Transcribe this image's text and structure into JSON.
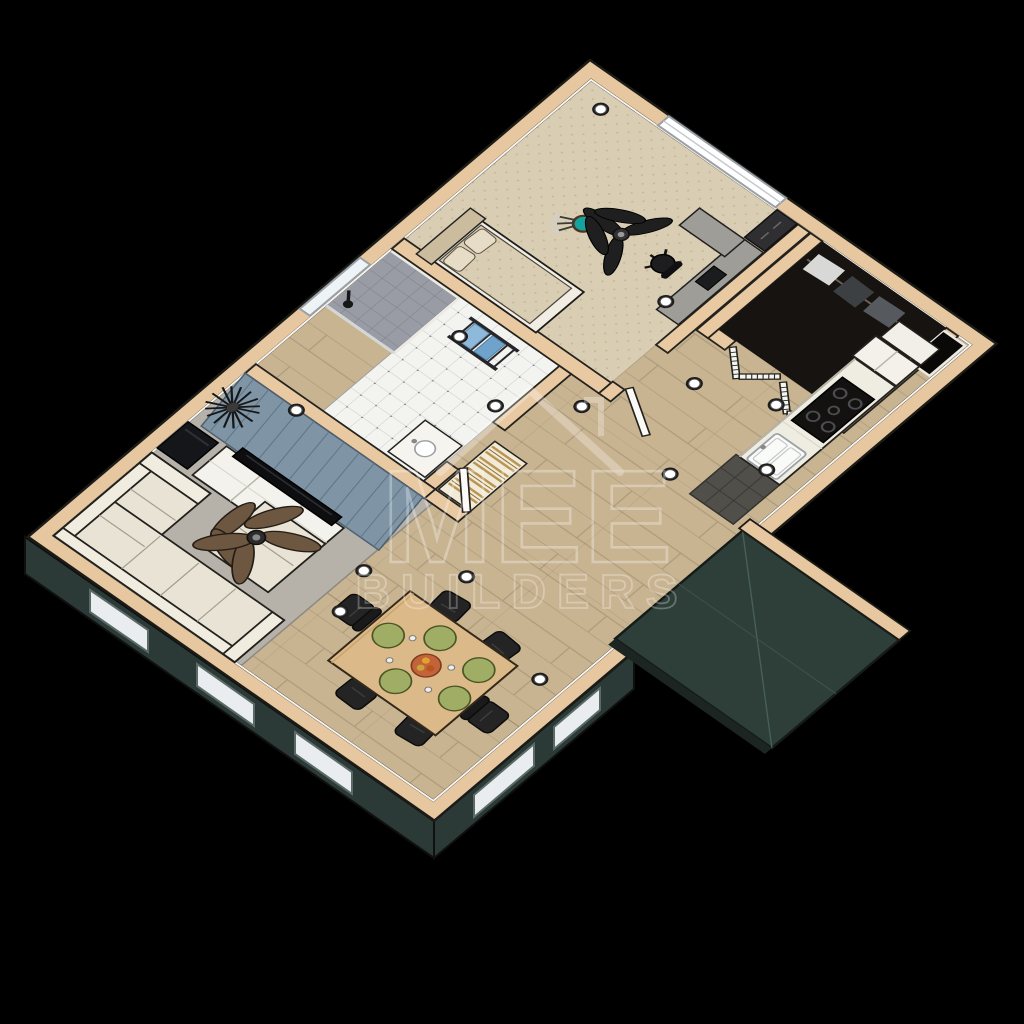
{
  "watermark": {
    "line1": "MEE",
    "line2": "BUILDERS",
    "icon": "house-roof-icon"
  },
  "scene": {
    "type": "3d-floor-plan-cutaway-render",
    "view": "aerial oblique, plan rotated diagonally on black background",
    "background_color": "#000000",
    "palette": {
      "floor_wood": "#c9b492",
      "bedroom_carpet": "#d9cdb3",
      "wall_cap_tan": "#e7c7a0",
      "wall_face_cream": "#efeade",
      "area_rug_gray": "#b7b2a9",
      "sofa_cream": "#e8e3d4",
      "accent_wall_blue": "#7f95a6",
      "exterior_teal": "#2c3b37",
      "golf_bag_teal": "#14a39e",
      "dining_table_wood": "#dcb988",
      "placemat_green": "#9fae64",
      "centerpiece_orange": "#c2633a",
      "fan_blade_brown": "#6d5741",
      "chair_black": "#242424",
      "bath_tile_white": "#f3f3ef",
      "shower_tile_gray": "#999ca4",
      "towel_blue": "#8fb9da"
    },
    "rooms": [
      {
        "name": "bedroom",
        "contents": [
          "bed-with-headboard-and-pillows",
          "golf-bag",
          "ceiling-fan",
          "desk",
          "office-chair",
          "dresser",
          "wide-window"
        ]
      },
      {
        "name": "bathroom",
        "contents": [
          "shower-stall",
          "checkered-tile-floor",
          "towel-ladder",
          "blue-towels",
          "vanity",
          "high-window",
          "shower-head"
        ]
      },
      {
        "name": "closet",
        "contents": [
          "bifold-louver-doors",
          "hanging-clothes",
          "corner-window-alcove"
        ]
      },
      {
        "name": "hallway",
        "contents": [
          "open-doors",
          "linen-louver-closet",
          "recessed-lights"
        ]
      },
      {
        "name": "kitchen",
        "contents": [
          "cooktop",
          "sink",
          "refrigerator",
          "pantry-cabinet",
          "counter",
          "dark-entry-mat"
        ]
      },
      {
        "name": "living-room",
        "contents": [
          "sectional-sofa",
          "ottoman",
          "area-rug",
          "tv-console",
          "flat-tv",
          "speaker-cabinet",
          "ceiling-fan",
          "starburst-wall-clock",
          "blue-accent-wall"
        ]
      },
      {
        "name": "dining-area",
        "contents": [
          "wood-table",
          "six-dark-chairs",
          "five-green-placemats",
          "fruit-centerpiece"
        ]
      }
    ],
    "exterior": [
      "teal-side-walls-with-windows",
      "teal-roof-block-bottom-right",
      "tan-wall-caps"
    ],
    "recessed_light_count": 14
  }
}
